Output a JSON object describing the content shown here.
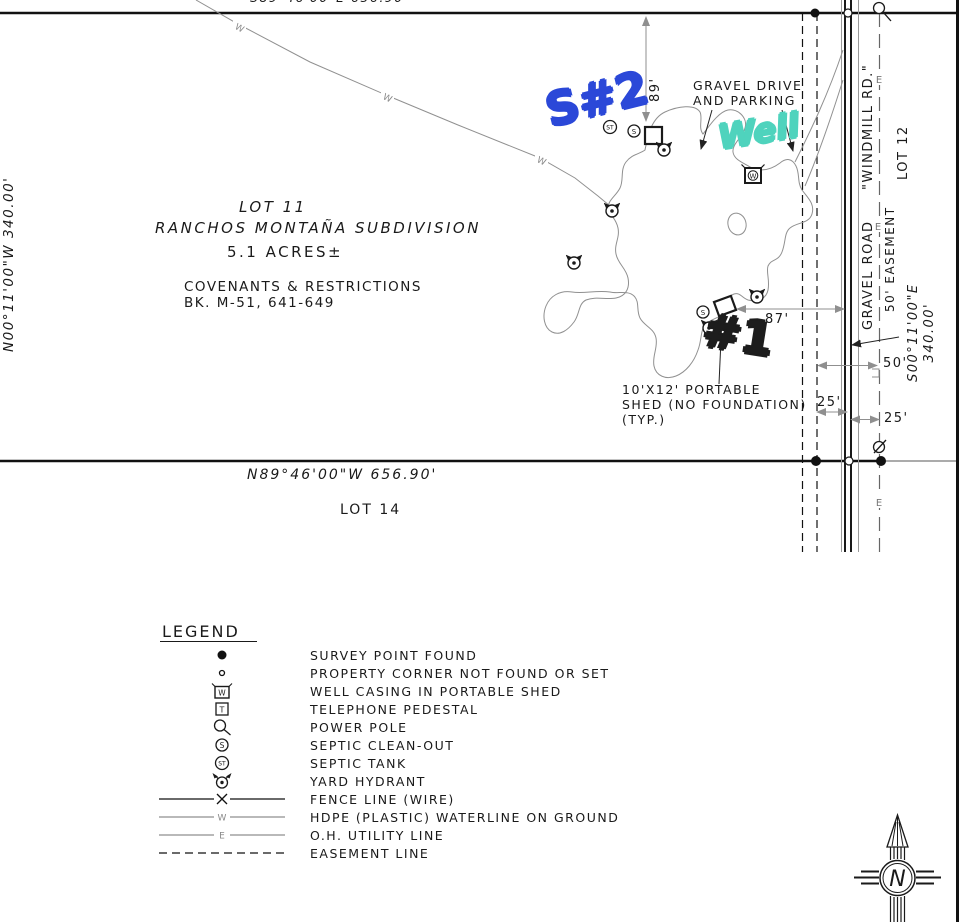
{
  "plat": {
    "north_boundary_clipped": "S89°46'00\"E   656.90'",
    "west_boundary": "N00°11'00\"W   340.00'",
    "south_boundary": "N89°46'00\"W   656.90'",
    "east_boundary": {
      "bearing": "S00°11'00\"E",
      "distance": "340.00'"
    },
    "lot11": {
      "name": "LOT 11",
      "subdivision": "RANCHOS MONTAÑA SUBDIVISION",
      "area": "5.1 ACRES±",
      "covenants": "COVENANTS & RESTRICTIONS",
      "book": "BK. M-51, 641-649"
    },
    "lot12": "LOT 12",
    "lot14": "LOT 14",
    "road": {
      "label": "GRAVEL ROAD",
      "name": "\"WINDMILL RD.\"",
      "easement": "50' EASEMENT"
    },
    "drive": {
      "line1": "GRAVEL DRIVE",
      "line2": "AND PARKING"
    },
    "shed_note": {
      "line1": "10'X12' PORTABLE",
      "line2": "SHED (NO FOUNDATION)",
      "line3": "(TYP.)"
    },
    "dims": {
      "d89": "89'",
      "d87": "87'",
      "d50": "50'",
      "d25a": "25'",
      "d25b": "25'"
    },
    "glyphs": {
      "water": "W",
      "electric": "E",
      "septic_tank": "ST",
      "septic_cleanout": "S",
      "well_casing": "W",
      "telephone": "T",
      "north": "N"
    }
  },
  "annotations": {
    "septic2": "S#2",
    "well": "Well",
    "septic1": "#1",
    "colors": {
      "septic2": "#2b48d8",
      "well": "#4fd3bd",
      "septic1": "#1d1d1d"
    }
  },
  "legend": {
    "title": "LEGEND",
    "items": [
      {
        "symbol": "survey-point-found",
        "label": "SURVEY POINT FOUND"
      },
      {
        "symbol": "property-corner",
        "label": "PROPERTY CORNER NOT FOUND OR SET"
      },
      {
        "symbol": "well-casing",
        "label": "WELL CASING IN PORTABLE SHED"
      },
      {
        "symbol": "telephone-pedestal",
        "label": "TELEPHONE PEDESTAL"
      },
      {
        "symbol": "power-pole",
        "label": "POWER POLE"
      },
      {
        "symbol": "septic-clean-out",
        "label": "SEPTIC CLEAN-OUT"
      },
      {
        "symbol": "septic-tank",
        "label": "SEPTIC TANK"
      },
      {
        "symbol": "yard-hydrant",
        "label": "YARD HYDRANT"
      },
      {
        "symbol": "fence-line",
        "label": "FENCE LINE (WIRE)"
      },
      {
        "symbol": "waterline",
        "label": "HDPE (PLASTIC) WATERLINE ON GROUND"
      },
      {
        "symbol": "utility-line",
        "label": "O.H. UTILITY LINE"
      },
      {
        "symbol": "easement-line",
        "label": "EASEMENT LINE"
      }
    ]
  }
}
